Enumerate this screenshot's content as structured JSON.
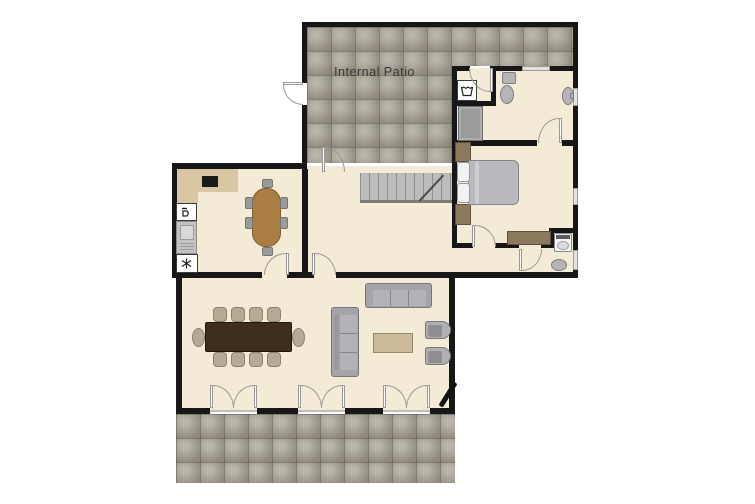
{
  "labels": {
    "internal_patio": "Internal Patio"
  },
  "palette": {
    "wall": "#171717",
    "floor": "#f4ebd7",
    "patio_base": "#a8a294",
    "window": "#e2e2e0",
    "door_line": "#9a9a98",
    "stairs": "#bcbcba",
    "counter": "#d9c7a3",
    "cooktop": "#191919",
    "kitchen_table": "#a87e42",
    "chair_grey": "#9a9a9a",
    "dining_table": "#3f2e1e",
    "dining_chair": "#b5aa94",
    "sofa": "#a5a5a9",
    "sofa_light": "#b3b3b7",
    "coffee_table": "#cbb998",
    "armchair": "#b0b0b2",
    "bed": "#b9babe",
    "pillow": "#f2f2f2",
    "wood": "#8d7a5e",
    "fixture": "#b5b5b7",
    "fixture_line": "#7f7f81",
    "label_color": "#3b3b3b"
  }
}
